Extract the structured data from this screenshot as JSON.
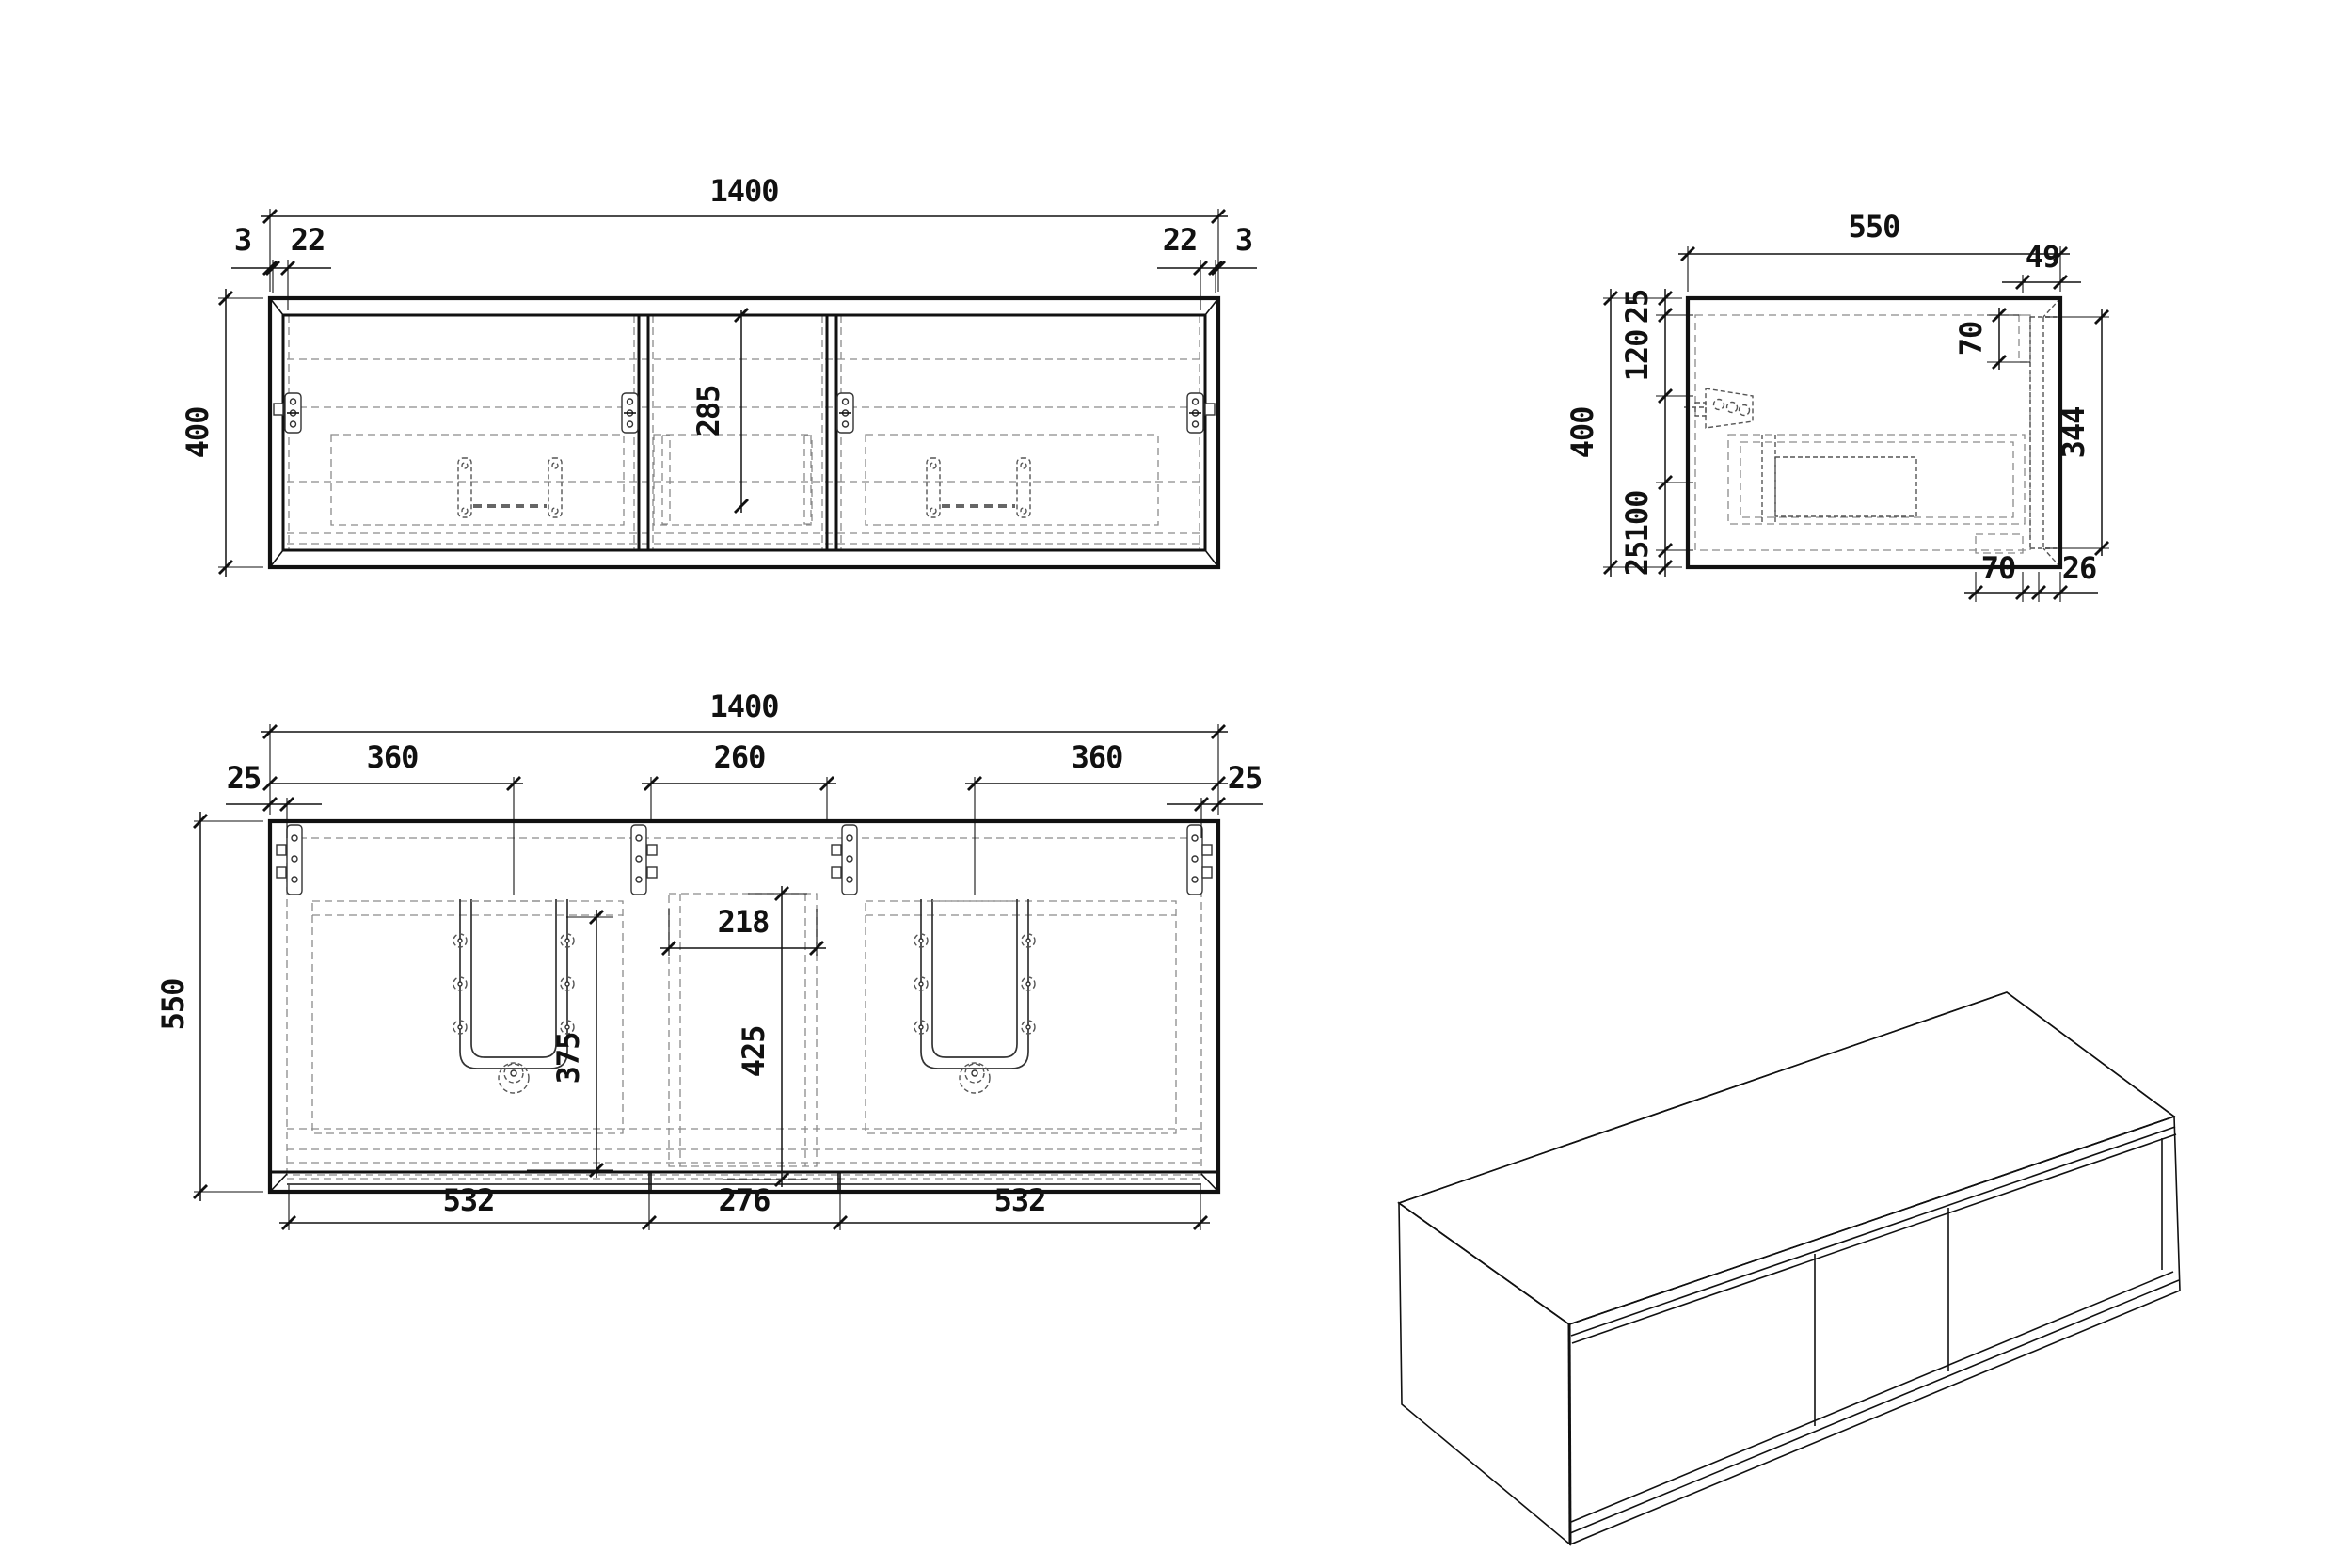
{
  "drawing": {
    "type": "furniture-technical-drawing",
    "subject": "wall-hung double-basin vanity cabinet, 3 doors",
    "colors": {
      "background": "#ffffff",
      "lines": "#111111",
      "hidden_lines": "#8a8a8a"
    },
    "front_view": {
      "width": "1400",
      "height": "400",
      "edge_left": "3",
      "frame_left": "22",
      "frame_right": "22",
      "edge_right": "3",
      "door_height": "285"
    },
    "side_view": {
      "depth": "550",
      "height": "400",
      "top_panel": "25",
      "top_offset": "120",
      "bottom_offset": "100",
      "bottom_panel": "25",
      "back_recess": "49",
      "top_inset": "70",
      "door_height": "344",
      "bottom_inset": "70",
      "door_thickness": "26"
    },
    "plan_view": {
      "width": "1400",
      "depth": "550",
      "side_panel_left": "25",
      "side_panel_right": "25",
      "basin_center_left": "360",
      "middle_width": "260",
      "basin_center_right": "360",
      "cutout_width": "218",
      "cutout_depth": "375",
      "middle_depth": "425",
      "door_left": "532",
      "door_middle": "276",
      "door_right": "532"
    }
  }
}
